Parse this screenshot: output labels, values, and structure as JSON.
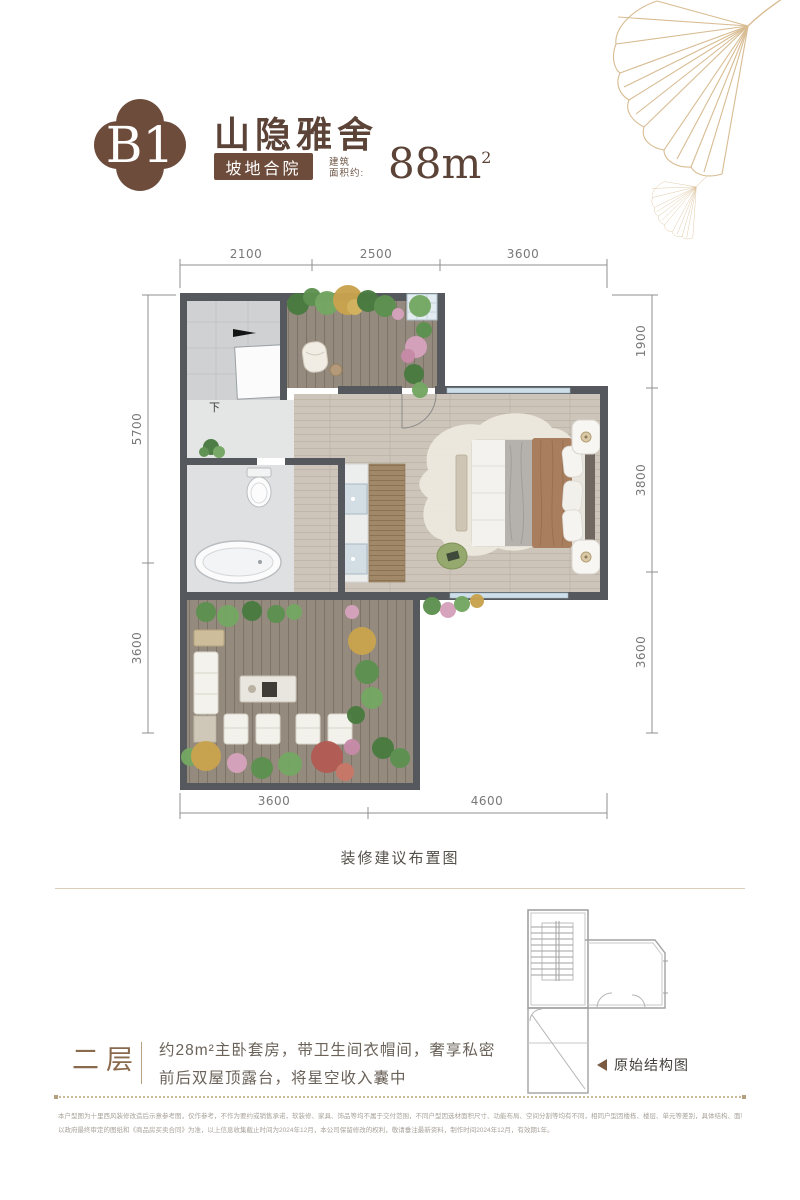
{
  "header": {
    "unit_code": "B1",
    "title": "山隐雅舍",
    "tag": "坡地合院",
    "area_label_top": "建筑",
    "area_label_bottom": "面积约:",
    "area_value": "88m",
    "area_superscript": "2"
  },
  "plan": {
    "caption": "装修建议布置图",
    "stair_direction_label": "下",
    "dimensions": {
      "top": [
        "2100",
        "2500",
        "3600"
      ],
      "left": [
        "5700",
        "3600"
      ],
      "right": [
        "1900",
        "3800",
        "3600"
      ],
      "bottom": [
        "3600",
        "4600"
      ]
    }
  },
  "structure_diagram": {
    "label": "原始结构图"
  },
  "floor_section": {
    "floor_label": "二层",
    "desc_line1": "约28m²主卧套房，带卫生间衣帽间，奢享私密",
    "desc_line2": "前后双屋顶露台，将星空收入囊中"
  },
  "disclaimer": {
    "line1": "本户型图为十里西风装修改造后示意参考图，仅作参考，不作为要约或销售承诺，软装修、家具、饰品等均不属于交付范围，不同户型因选材面积尺寸、功能布局、空间分割等均有不同，相同户型因楼栋、楼层、单元等差别，具体结构、面积等也可能不同，具体",
    "line2": "以政府最终审定的图纸和《商品房买卖合同》为准，以上信息收集截止时间为2024年12月，本公司保留修改的权利，敬请垂注最新资料，制作时间2024年12月，有效期1年。"
  },
  "colors": {
    "brand_brown": "#6d4c3c",
    "title_brown": "#5c4337",
    "gold_line": "#d8bc92",
    "wall_dark": "#55585c",
    "window_blue": "#cfdfe9",
    "dim_gray": "#787878"
  }
}
